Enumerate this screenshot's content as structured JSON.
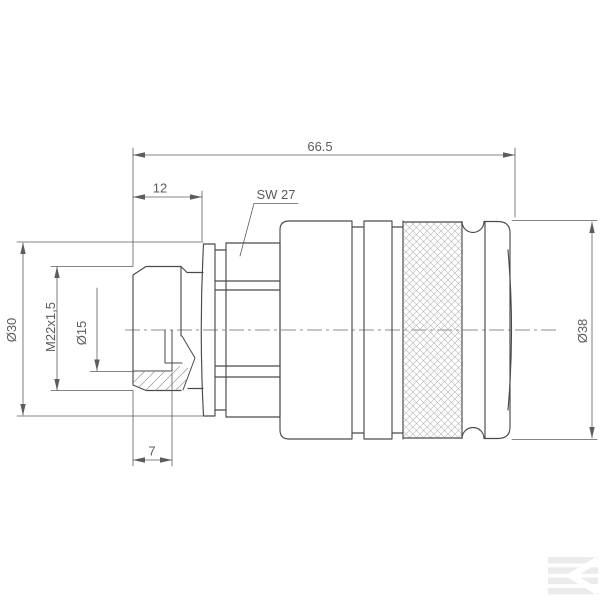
{
  "drawing": {
    "dims": {
      "overall_length": "66.5",
      "thread_length": "12",
      "wrench_size": "SW 27",
      "flange_diameter": "Ø30",
      "thread_spec": "M22x1,5",
      "bore_diameter": "Ø15",
      "body_diameter": "Ø38",
      "bore_depth": "7"
    },
    "colors": {
      "background": "#ffffff",
      "outline": "#4a4a4a",
      "dimension": "#5c5c5c",
      "centerline": "#8c8c8c",
      "section_hatch": "#8a8a8a",
      "knurl_hatch": "#b3b3b3",
      "watermark": "#ebebeb"
    },
    "watermark_letter": "K"
  }
}
